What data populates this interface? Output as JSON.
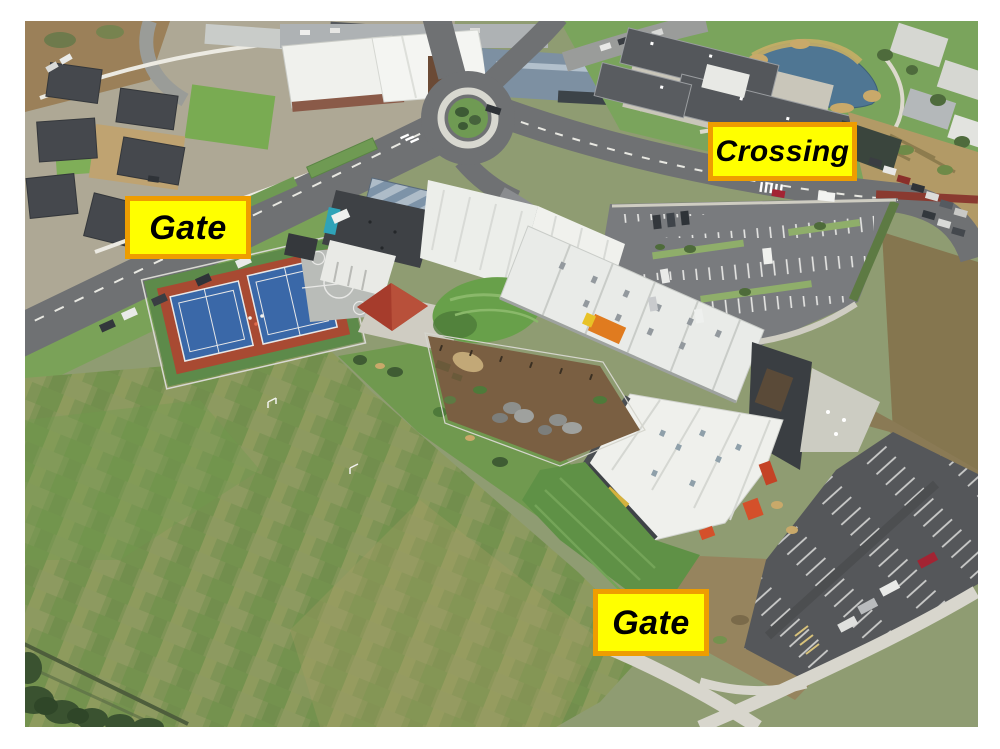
{
  "annotations": {
    "style": {
      "fill": "#ffff00",
      "border_color": "#ee9d01",
      "text_color": "#000000"
    },
    "items": [
      {
        "id": "gate-left",
        "text": "Gate"
      },
      {
        "id": "crossing",
        "text": "Crossing"
      },
      {
        "id": "gate-bottom",
        "text": "Gate"
      }
    ]
  },
  "scene": {
    "description": "Aerial drone photo of a school campus: roundabout and shops at top, houses upper-left, retirement village and pond upper-right, school buildings with white roofs in the centre, tennis and basketball courts, playground, large grass field lower-left, car parks on the right.",
    "palette": {
      "photo_frame": "#ffffff",
      "road": "#6f7173",
      "grass_field": "#7f9456",
      "lawn": "#6f9a53",
      "roof_dark": "#44474b",
      "roof_white": "#eceeea",
      "roof_blue_grey": "#7d93a8",
      "court_blue": "#3a68a8",
      "court_red": "#a84a32",
      "mulch_brown": "#7a5f42",
      "scrub_brown": "#86784f",
      "new_asphalt": "#55575a",
      "concrete": "#d8d6cd",
      "pond_water": "#4f7693",
      "accent_orange": "#d4502a"
    }
  }
}
